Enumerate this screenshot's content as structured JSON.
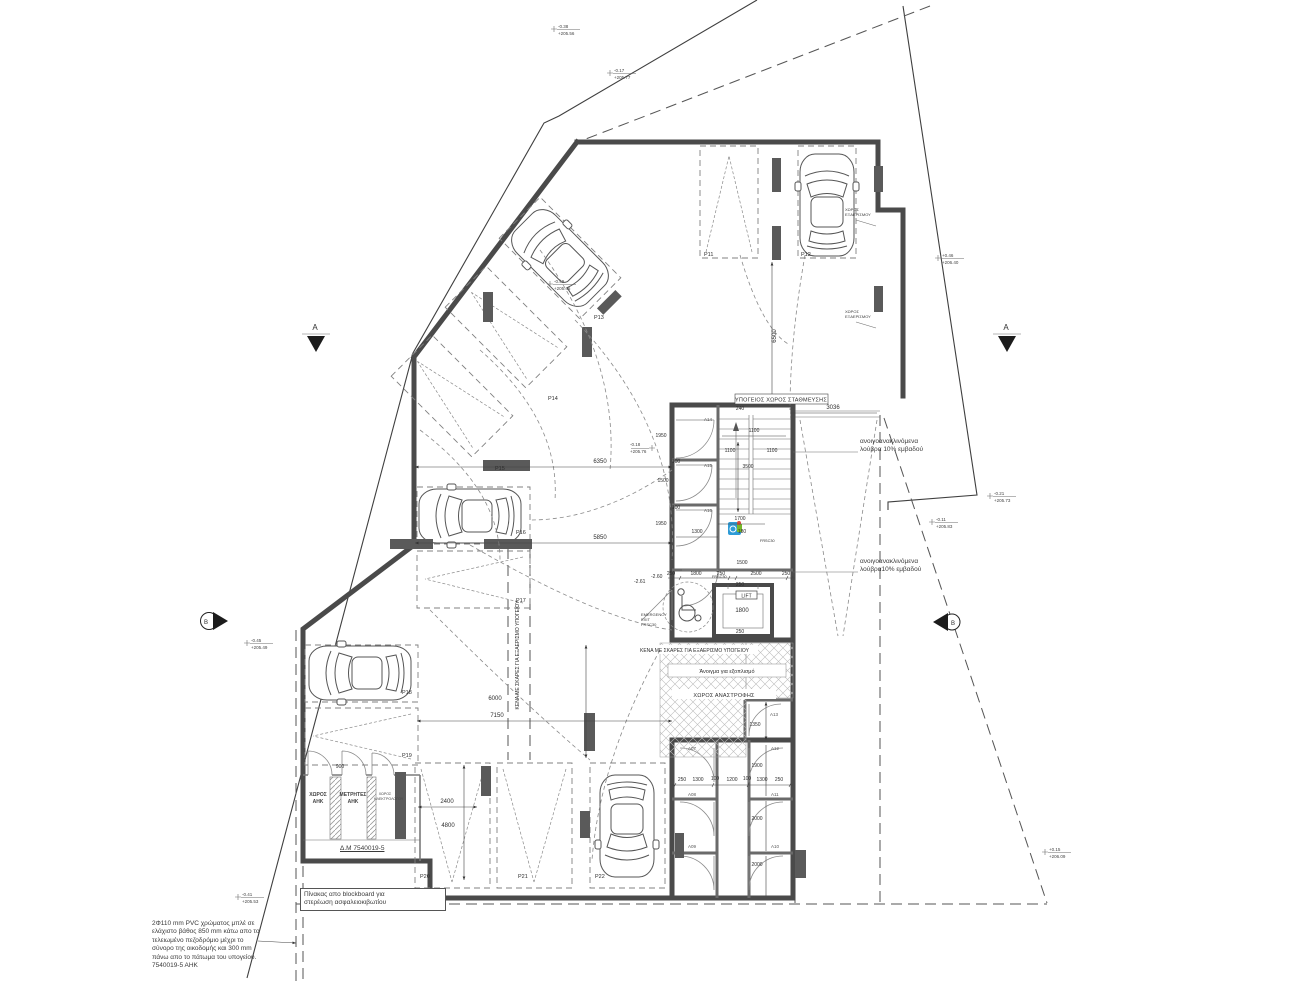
{
  "labels": {
    "parking_title": "ΥΠΟΓΕΙΟΣ ΧΩΡΟΣ ΣΤΑΘΜΕΥΣΗΣ",
    "vents": "ΚΕΝΑ ΜΕ ΣΚΑΡΕΣ ΓΙΑ ΕΞΑΕΡΙΣΜΟ ΥΠΟΓΕΙΟΥ",
    "equipment_opening": "Άνοιγμα για εξοπλισμό",
    "turning_area": "ΧΩΡΟΣ ΑΝΑΣΤΡΟΦΗΣ",
    "eac_room": "ΧΩΡΟΣ\nΑΗΚ",
    "eac_meters": "ΜΕΤΡΗΤΕΣ\nΑΗΚ",
    "electrician_room": "ΧΩΡΟΣ\nΗΛΕΚΤΡΟΛΟΓΟΥ",
    "dm_number": "Δ.Μ 7540019-5",
    "blockboard_note": "Πίνακας απο blockboard για\nστερέωση ασφαλειοκιβωτίου",
    "pvc_note": "2Φ110 mm PVC χρώματος μπλέ σε\nελάχιστο βάθος 850 mm κάτω απο το\nτελειωμένο πεζοδρόμιο μέχρι το\nσύνορο της οικοδομής και 300 mm\nπάνω απο το πάτωμα του υπογείου.\n7540019-5 ΑΗΚ",
    "louvres_note_1": "ανοιγοανακλινόμενα\nλούβρα 10% εμβαδού",
    "louvres_note_2": "ανοιγοανακλινόμενα\nλούβρα10% εμβαδού",
    "vent_space": "ΧΩΡΟΣ\nΕΞΑΕΡΙΣΜΟΥ",
    "emergency_exit": "EMERGENCY\nEXIT\nFRSC30",
    "frsc30": "FRSC30",
    "lift": "LIFT"
  },
  "parking": {
    "p11": "P11",
    "p12": "P12",
    "p13": "P13",
    "p14": "P14",
    "p15": "P15",
    "p16": "P16",
    "p17": "P17",
    "p18": "P18",
    "p19": "P19",
    "p20": "P20",
    "p21": "P21",
    "p22": "P22"
  },
  "rooms": {
    "a07": "A07",
    "a08": "A08",
    "a09": "A09",
    "a10": "A10",
    "a11": "A11",
    "a12": "A12",
    "a13": "A13",
    "a14": "A14",
    "a15": "A15",
    "a16": "A16"
  },
  "sections": {
    "a": "A",
    "b": "B"
  },
  "dims": {
    "d100": "100",
    "d180": "180",
    "d240": "240",
    "d250": "250",
    "d900": "900",
    "d1100": "1100",
    "d1200": "1200",
    "d1300": "1300",
    "d1350": "1350",
    "d1500": "1500",
    "d1700": "1700",
    "d1800": "1800",
    "d1900": "1900",
    "d1950": "1950",
    "d2000": "2000",
    "d2400": "2400",
    "d2500": "2500",
    "d3036": "3036",
    "d3500": "3500",
    "d4800": "4800",
    "d5850": "5850",
    "d6000": "6000",
    "d6350": "6350",
    "d6500": "6500",
    "d7150": "7150",
    "m260": "-2.60",
    "m261": "-2.61"
  },
  "levels": [
    {
      "off": "-0.38",
      "el": "+205.56"
    },
    {
      "off": "-0.17",
      "el": "+205.77"
    },
    {
      "off": "+0.46",
      "el": "+206.40"
    },
    {
      "off": "-0.21",
      "el": "+205.73"
    },
    {
      "off": "-0.11",
      "el": "+205.83"
    },
    {
      "off": "-0.49",
      "el": "+205.45"
    },
    {
      "off": "-0.18",
      "el": "+205.76"
    },
    {
      "off": "-0.45",
      "el": "+205.49"
    },
    {
      "off": "-0.41",
      "el": "+205.53"
    },
    {
      "off": "+0.15",
      "el": "+206.09"
    }
  ]
}
